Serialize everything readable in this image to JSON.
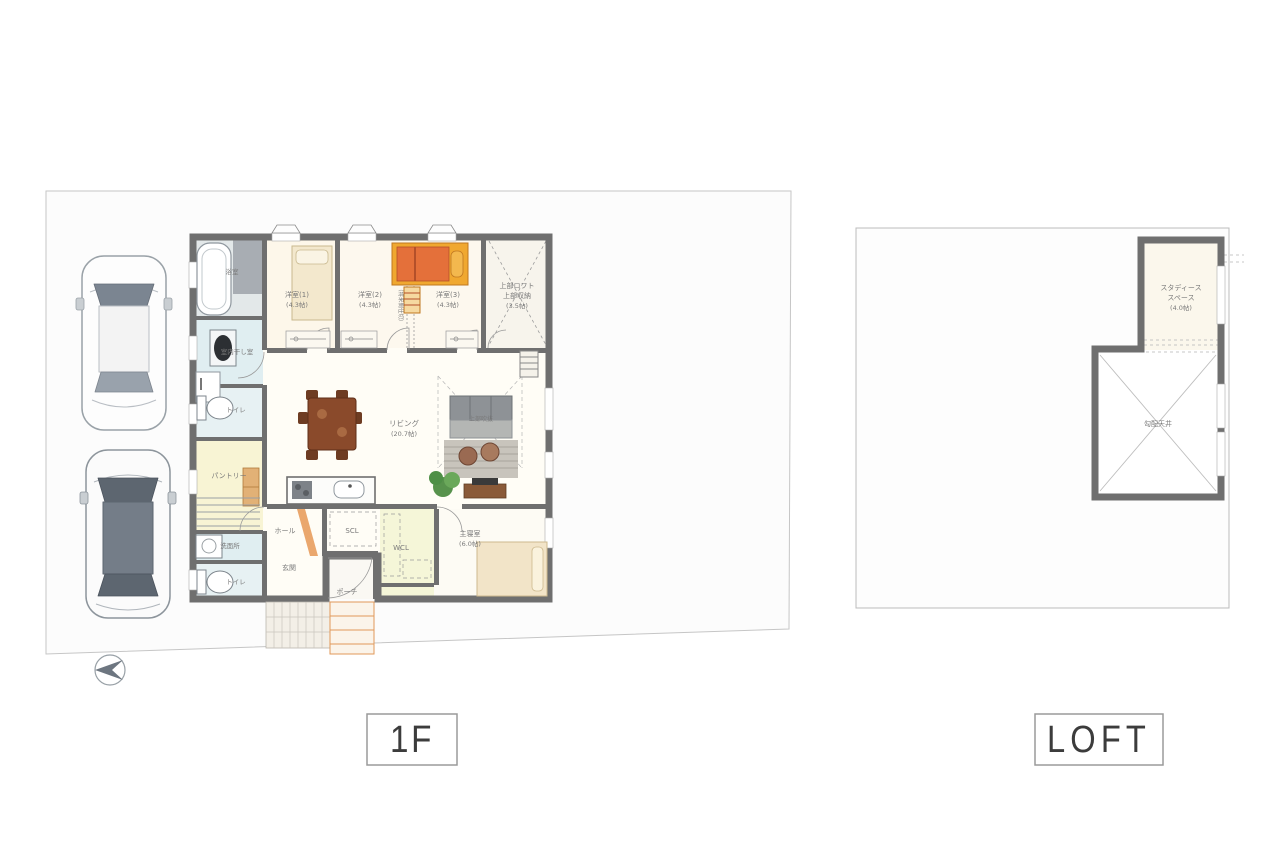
{
  "page": {
    "title": "floor-plan-sheet",
    "background": "#ffffff"
  },
  "colors": {
    "wall": "#6f6f6f",
    "site_fill": "#fcfcfc",
    "site_border": "#c6c6c6",
    "accent_orange_bed": "#e4703a",
    "accent_orange_frame": "#f0a830",
    "tatami_beige": "#f2e4c8",
    "water_blue": "#e0eef1",
    "pantry_yellow": "#f8f4d4",
    "label_gray": "#7a7a7a"
  },
  "captions": [
    {
      "id": "1f",
      "label": "1F"
    },
    {
      "id": "loft",
      "label": "LOFT"
    }
  ],
  "plan_1f": {
    "rooms": {
      "bath": {
        "name": "浴室"
      },
      "drying": {
        "name": "室内干し室"
      },
      "toilet1": {
        "name": "トイレ"
      },
      "pantry": {
        "name": "パントリー"
      },
      "washroom": {
        "name": "洗面所"
      },
      "toilet2": {
        "name": "トイレ"
      },
      "bedroom1": {
        "name": "洋室(1)",
        "size": "(4.3帖)"
      },
      "bedroom2": {
        "name": "洋室(2)",
        "size": "(4.3帖)"
      },
      "bedroom3": {
        "name": "洋室(3)",
        "size": "(4.3帖)"
      },
      "partition_note": "（将来間仕切）",
      "upper_storage": {
        "name": "上部ロフト",
        "name2": "上部収納",
        "size": "(3.5帖)"
      },
      "living": {
        "name": "リビング",
        "size": "(20.7帖)"
      },
      "void_note": "上部吹抜",
      "hall": {
        "name": "ホール"
      },
      "scl": {
        "name": "SCL"
      },
      "entrance": {
        "name": "玄関"
      },
      "porch": {
        "name": "ポーチ"
      },
      "wcl": {
        "name": "WCL"
      },
      "master": {
        "name": "主寝室",
        "size": "(6.0帖)"
      }
    }
  },
  "plan_loft": {
    "rooms": {
      "study": {
        "name_line1": "スタディース",
        "name_line2": "スペース",
        "size": "(4.0帖)"
      },
      "sloped_ceiling": {
        "name": "勾配天井"
      }
    }
  }
}
